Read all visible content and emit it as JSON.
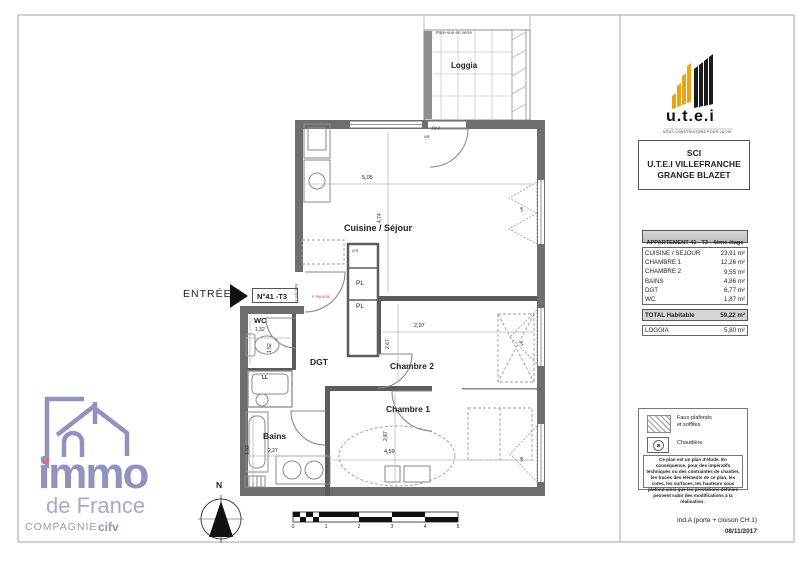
{
  "colors": {
    "utei_yellow": "#E7A614",
    "logo_purple": "#9193BE",
    "logo_red": "#E2696E",
    "wall_gray": "#6E6E6E",
    "annotation_red": "#C0392B"
  },
  "branding": {
    "utei": {
      "name": "u.t.e.i",
      "tagline": "NOUS CONSTRUISONS POUR LA VIE"
    },
    "sci": {
      "line1": "SCI",
      "line2": "U.T.E.I VILLEFRANCHE",
      "line3": "GRANGE BLAZET"
    },
    "immo": {
      "name": "immo",
      "sub": "de France",
      "company": "COMPAGNIE",
      "company_bold": "cifv"
    }
  },
  "surface_table": {
    "title": "APPARTEMENT 41 - T3 - 4ème étage",
    "rows": [
      {
        "label": "CUISINE / SEJOUR",
        "value": "23,91 m²"
      },
      {
        "label": "CHAMBRE 1",
        "value": "12,26 m²"
      },
      {
        "label": "CHAMBRE 2",
        "value": "9,55 m²"
      },
      {
        "label": "BAINS",
        "value": "4,86 m²"
      },
      {
        "label": "DGT",
        "value": "6,77 m²"
      },
      {
        "label": "WC",
        "value": "1,87 m²"
      }
    ],
    "total": {
      "label": "TOTAL Habitable",
      "value": "59,22 m²"
    },
    "loggia": {
      "label": "LOGGIA",
      "value": "5,80 m²"
    }
  },
  "plan": {
    "entrance_label": "ENTRÉE",
    "unit_box": "N°41 -T3",
    "loggia": "Loggia",
    "pare_vue": "Pare-vue en verre",
    "north": "N",
    "rooms": {
      "cuisine": {
        "label": "Cuisine / Séjour",
        "w": "5,05",
        "h": "4,74"
      },
      "wc": {
        "label": "WC",
        "w": "1,32",
        "h": "1,52"
      },
      "dgt": {
        "label": "DGT"
      },
      "chambre2": {
        "label": "Chambre 2",
        "w": "2,97",
        "h": "2,67"
      },
      "chambre1": {
        "label": "Chambre 1",
        "w": "4,59",
        "h": "2,87"
      },
      "bains": {
        "label": "Bains",
        "w": "2,27",
        "h": "1,92"
      }
    },
    "closets": {
      "gti": "GTI",
      "pl": "PL",
      "ll": "LL"
    },
    "annotations": {
      "sv": "Sv 2",
      "vr": "VR",
      "door_red": "P. PALIERE"
    },
    "scale_ticks": [
      "0",
      "1",
      "2",
      "3",
      "4",
      "5"
    ]
  },
  "legend": {
    "faux_plafonds_1": "Faux-plafonds",
    "faux_plafonds_2": "et soffites",
    "chaudiere": "Chaudière",
    "disclaimer": "Ce plan est un plan d'étude. En conséquence, pour des impératifs techniques ou des contraintes de chantier, les tracés des éléments de ce plan, les cotes, les surfaces, les hauteurs sous plafond ainsi que les prestations définies peuvent subir des modifications à la réalisation .",
    "revision": "Ind.A (porte + cloison CH.1)",
    "date": "08/11/2017"
  }
}
